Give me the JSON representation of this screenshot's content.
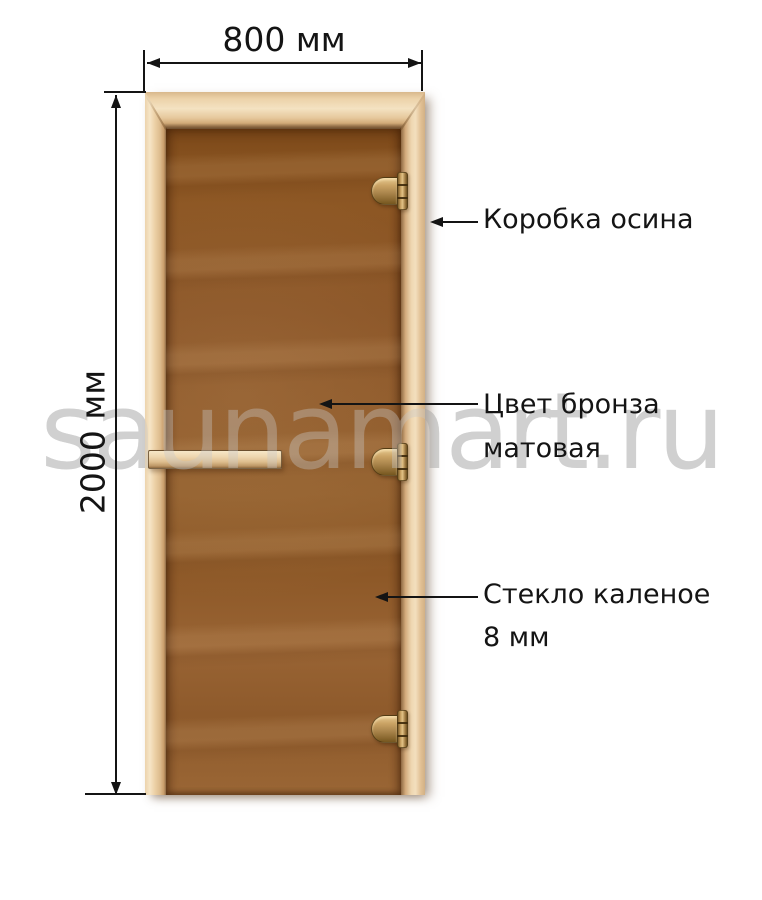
{
  "diagram": {
    "watermark": {
      "text": "saunamart.ru",
      "color": "#d6d6d6"
    },
    "dimensions": {
      "width": {
        "label": "800 мм"
      },
      "height": {
        "label": "2000 мм"
      }
    },
    "annotations": {
      "frame": {
        "label": "Коробка осина"
      },
      "glass_color": {
        "line1": "Цвет бронза",
        "line2": "матовая"
      },
      "glass_type": {
        "line1": "Стекло каленое",
        "line2": "8 мм"
      }
    },
    "door": {
      "hinge_count": 3,
      "colors": {
        "frame_wood": "#e8cda2",
        "glass_bronze": "#8a5426",
        "hinge_brass": "#b08d4f",
        "dimension_lines": "#141414"
      }
    }
  }
}
